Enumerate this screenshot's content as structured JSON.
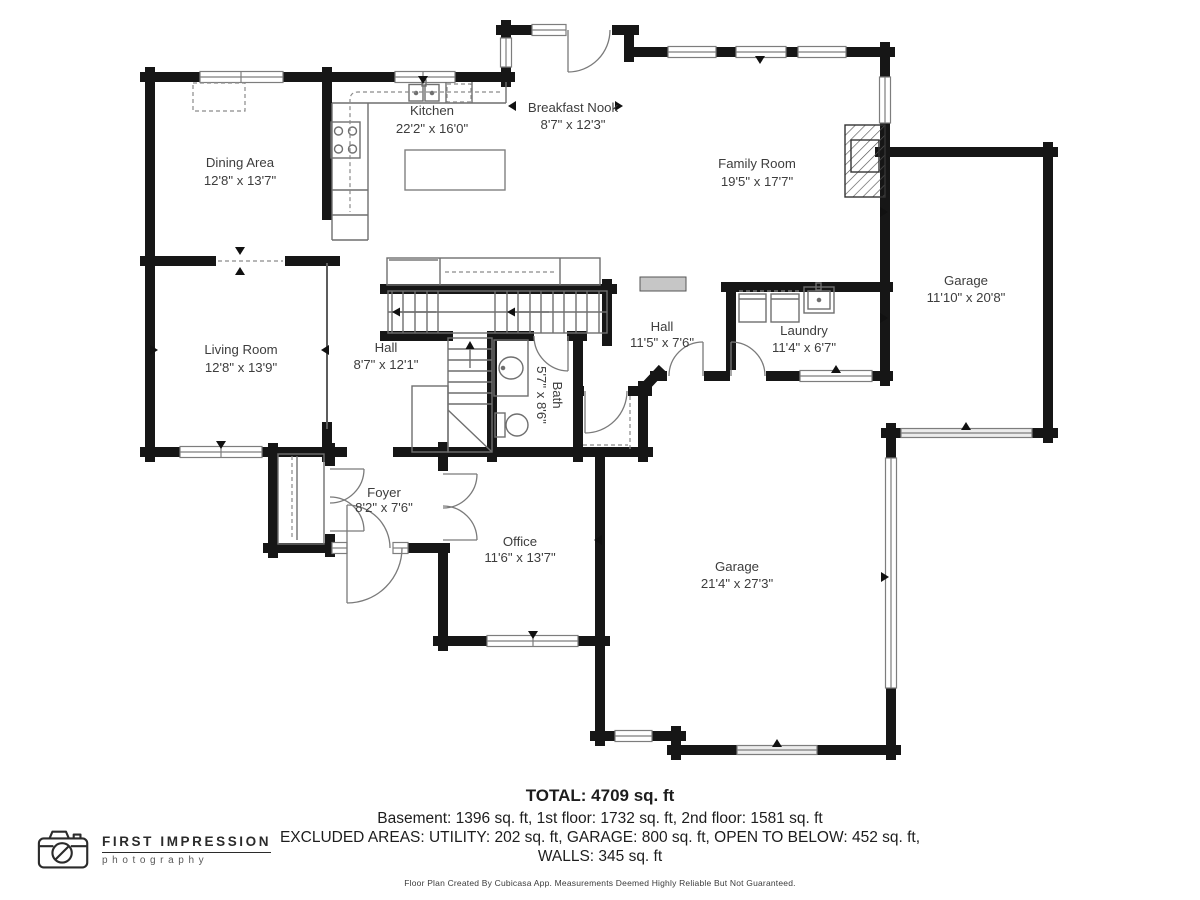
{
  "plan": {
    "rooms": {
      "dining": {
        "name": "Dining Area",
        "dims": "12'8\" x 13'7\""
      },
      "kitchen": {
        "name": "Kitchen",
        "dims": "22'2\" x 16'0\""
      },
      "breakfast_nook": {
        "name": "Breakfast Nook",
        "dims": "8'7\" x 12'3\""
      },
      "family_room": {
        "name": "Family Room",
        "dims": "19'5\" x 17'7\""
      },
      "garage_side": {
        "name": "Garage",
        "dims": "11'10\" x 20'8\""
      },
      "living_room": {
        "name": "Living Room",
        "dims": "12'8\" x 13'9\""
      },
      "hall_main": {
        "name": "Hall",
        "dims": "8'7\" x 12'1\""
      },
      "hall_rear": {
        "name": "Hall",
        "dims": "11'5\" x 7'6\""
      },
      "laundry": {
        "name": "Laundry",
        "dims": "11'4\" x 6'7\""
      },
      "bath": {
        "name": "Bath",
        "dims": "5'7\" x 8'6\""
      },
      "foyer": {
        "name": "Foyer",
        "dims": "8'2\" x 7'6\""
      },
      "office": {
        "name": "Office",
        "dims": "11'6\" x 13'7\""
      },
      "garage_main": {
        "name": "Garage",
        "dims": "21'4\" x 27'3\""
      }
    }
  },
  "summary": {
    "total": "TOTAL: 4709 sq. ft",
    "floors": "Basement: 1396 sq. ft, 1st floor: 1732 sq. ft, 2nd floor: 1581 sq. ft",
    "excluded_1": "EXCLUDED AREAS: UTILITY: 202 sq. ft, GARAGE: 800 sq. ft, OPEN TO BELOW: 452 sq. ft,",
    "excluded_2": "WALLS: 345 sq. ft",
    "disclaimer": "Floor Plan Created By Cubicasa App. Measurements Deemed Highly Reliable But Not Guaranteed."
  },
  "logo": {
    "brand": "FIRST IMPRESSION",
    "tagline": "photography"
  },
  "colors": {
    "wall": "#161616",
    "label_text": "#3d3d3d",
    "thin_line": "#6f6f6f",
    "window_line": "#7d7d7d"
  }
}
